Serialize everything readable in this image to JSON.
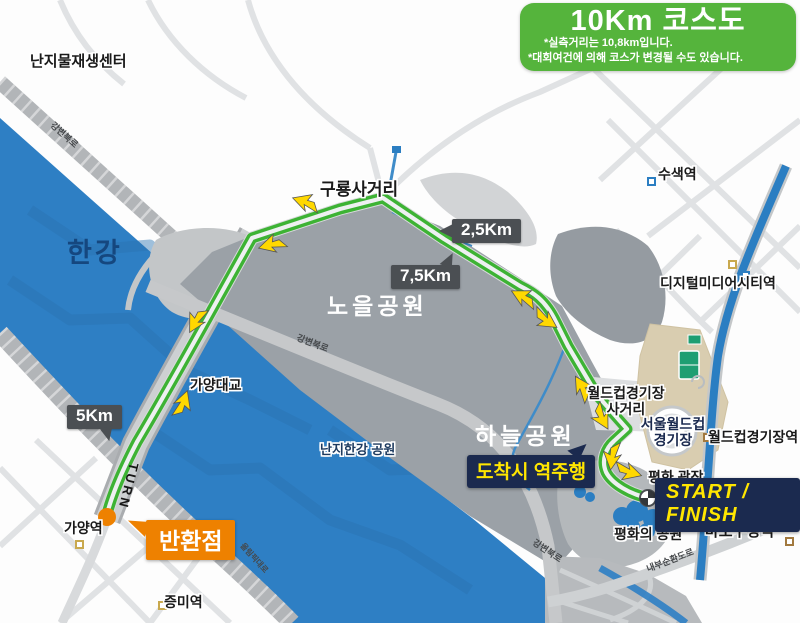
{
  "title_box": {
    "title": "10Km 코스도",
    "note1": "*실측거리는 10,8km입니다.",
    "note2": "*대회여건에 의해 코스가 변경될 수도 있습니다."
  },
  "course": {
    "start_finish": "START / FINISH",
    "reverse_at_finish": "도착시 역주행",
    "turn_point": "반환점",
    "turn_road_text": "TURN",
    "km_2_5": "2,5Km",
    "km_7_5": "7,5Km",
    "km_5": "5Km"
  },
  "places": {
    "nanji_recycle_center": "난지물재생센터",
    "han_river": "한강",
    "guryong_junction": "구룡사거리",
    "noeul_park": "노을공원",
    "haneul_park": "하늘공원",
    "gayang_bridge": "가양대교",
    "nanji_hangang_park": "난지한강 공원",
    "worldcup_junction_line1": "월드컵경기장",
    "worldcup_junction_line2": "사거리",
    "seoul_worldcup_line1": "서울월드컵",
    "seoul_worldcup_line2": "경기장",
    "peace_plaza": "평화 광장",
    "peace_park": "평화의 공원"
  },
  "stations": {
    "susaek": "수색역",
    "dmc": "디지털미디어시티역",
    "worldcup_stadium": "월드컵경기장역",
    "mapo_gu_office": "마포구청역",
    "gayang": "가양역",
    "jeungmi": "증미역"
  },
  "roads": {
    "gangbyeon_1": "강변북로",
    "gangbyeon_2": "강변북로",
    "gangbyeon_3": "강변북로",
    "naebu_expwy": "내부순환도로",
    "olympic_expwy": "올림픽대로"
  },
  "colors": {
    "theme_green": "#55b43c",
    "route_green": "#3db334",
    "navy": "#1b2a4f",
    "accent_yellow": "#ffe600",
    "arrow_yellow": "#ffd800",
    "orange": "#ee8100",
    "river_blue": "#2e7fc4",
    "park_gray": "#9ba1a7",
    "badge_dark": "#4b4f53"
  }
}
